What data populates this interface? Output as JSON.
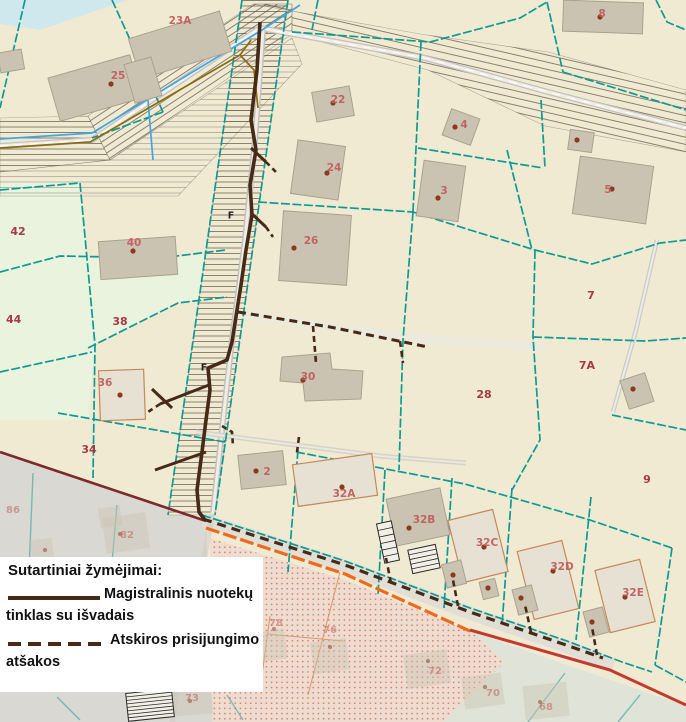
{
  "legend": {
    "title": "Sutartiniai žymėjimai:",
    "main_line_label_1": "Magistralinis nuotekų",
    "main_line_label_2": "tinklas su išvadais",
    "branch_line_label_1": "Atskiros prisijungimo",
    "branch_line_label_2": "atšakos"
  },
  "map": {
    "building_labels": [
      {
        "t": "23A",
        "x": 180,
        "y": 21
      },
      {
        "t": "25",
        "x": 118,
        "y": 76
      },
      {
        "t": "22",
        "x": 338,
        "y": 100
      },
      {
        "t": "4",
        "x": 464,
        "y": 125
      },
      {
        "t": "24",
        "x": 334,
        "y": 168
      },
      {
        "t": "3",
        "x": 444,
        "y": 191
      },
      {
        "t": "8",
        "x": 602,
        "y": 14
      },
      {
        "t": "5",
        "x": 608,
        "y": 190
      },
      {
        "t": "40",
        "x": 134,
        "y": 243
      },
      {
        "t": "26",
        "x": 311,
        "y": 241
      },
      {
        "t": "36",
        "x": 105,
        "y": 383
      },
      {
        "t": "30",
        "x": 308,
        "y": 377
      },
      {
        "t": "2",
        "x": 267,
        "y": 472
      },
      {
        "t": "32A",
        "x": 344,
        "y": 494
      },
      {
        "t": "32B",
        "x": 424,
        "y": 520
      },
      {
        "t": "32C",
        "x": 487,
        "y": 543
      },
      {
        "t": "32D",
        "x": 562,
        "y": 567
      },
      {
        "t": "32E",
        "x": 633,
        "y": 593
      }
    ],
    "faint_labels": [
      {
        "t": "82",
        "x": 127,
        "y": 535
      },
      {
        "t": "86",
        "x": 6,
        "y": 510
      },
      {
        "t": "78",
        "x": 276,
        "y": 623
      },
      {
        "t": "76",
        "x": 330,
        "y": 630
      },
      {
        "t": "73",
        "x": 192,
        "y": 698
      },
      {
        "t": "72",
        "x": 435,
        "y": 671
      },
      {
        "t": "70",
        "x": 493,
        "y": 693
      },
      {
        "t": "68",
        "x": 546,
        "y": 707
      }
    ],
    "parcel_labels": [
      {
        "t": "42",
        "x": 18,
        "y": 232
      },
      {
        "t": "44",
        "x": 6,
        "y": 320
      },
      {
        "t": "38",
        "x": 120,
        "y": 322
      },
      {
        "t": "34",
        "x": 89,
        "y": 450
      },
      {
        "t": "28",
        "x": 484,
        "y": 395
      },
      {
        "t": "7",
        "x": 591,
        "y": 296
      },
      {
        "t": "7A",
        "x": 587,
        "y": 366
      },
      {
        "t": "9",
        "x": 647,
        "y": 480
      }
    ],
    "f_markers": [
      {
        "t": "F",
        "x": 231,
        "y": 216
      },
      {
        "t": "F",
        "x": 204,
        "y": 368
      }
    ],
    "survey_dots": [
      [
        111,
        84
      ],
      [
        333,
        103
      ],
      [
        327,
        173
      ],
      [
        455,
        127
      ],
      [
        438,
        198
      ],
      [
        600,
        17
      ],
      [
        612,
        189
      ],
      [
        577,
        140
      ],
      [
        133,
        251
      ],
      [
        294,
        248
      ],
      [
        120,
        395
      ],
      [
        303,
        380
      ],
      [
        256,
        471
      ],
      [
        342,
        487
      ],
      [
        409,
        528
      ],
      [
        484,
        547
      ],
      [
        453,
        575
      ],
      [
        488,
        588
      ],
      [
        553,
        571
      ],
      [
        521,
        598
      ],
      [
        625,
        597
      ],
      [
        592,
        622
      ],
      [
        633,
        389
      ]
    ],
    "faint_dots": [
      [
        120,
        534
      ],
      [
        190,
        701
      ],
      [
        274,
        629
      ],
      [
        330,
        647
      ],
      [
        428,
        661
      ],
      [
        485,
        687
      ],
      [
        540,
        702
      ],
      [
        45,
        550
      ]
    ]
  },
  "colors": {
    "parcel_fill": "#f1ead3",
    "green_fill": "#e9f3dd",
    "water_fill": "#cfe8ee",
    "boundary_teal": "#0d9a92",
    "building_fill": "#cbc3b1",
    "building_stroke": "#aaa28e",
    "light_building_fill": "#e7e1d4",
    "light_building_stroke": "#c3895a",
    "building_label": "#c05f5f",
    "parcel_label": "#a63a47",
    "dot_brown": "#8a3a1f",
    "sewer_brown": "#452a18",
    "road_gray": "#c3c1ba",
    "road_inner": "#efede5",
    "hatch": "#5c5347",
    "blue_line": "#3fa7e6",
    "olive_line": "#8a6c14",
    "maroon_line": "#7c2a2a",
    "orange_line": "#f06a1e",
    "red_line": "#c23b2e",
    "gray_zone": "#dad8d2",
    "dotted_zone_fill": "#eddccf",
    "dotted_zone_dot": "#d8604f",
    "se_zone_fill": "#dfe3d8",
    "orange_parcel_line": "#d98a5c",
    "f_marker": "#222222",
    "legend_text": "#111111"
  }
}
